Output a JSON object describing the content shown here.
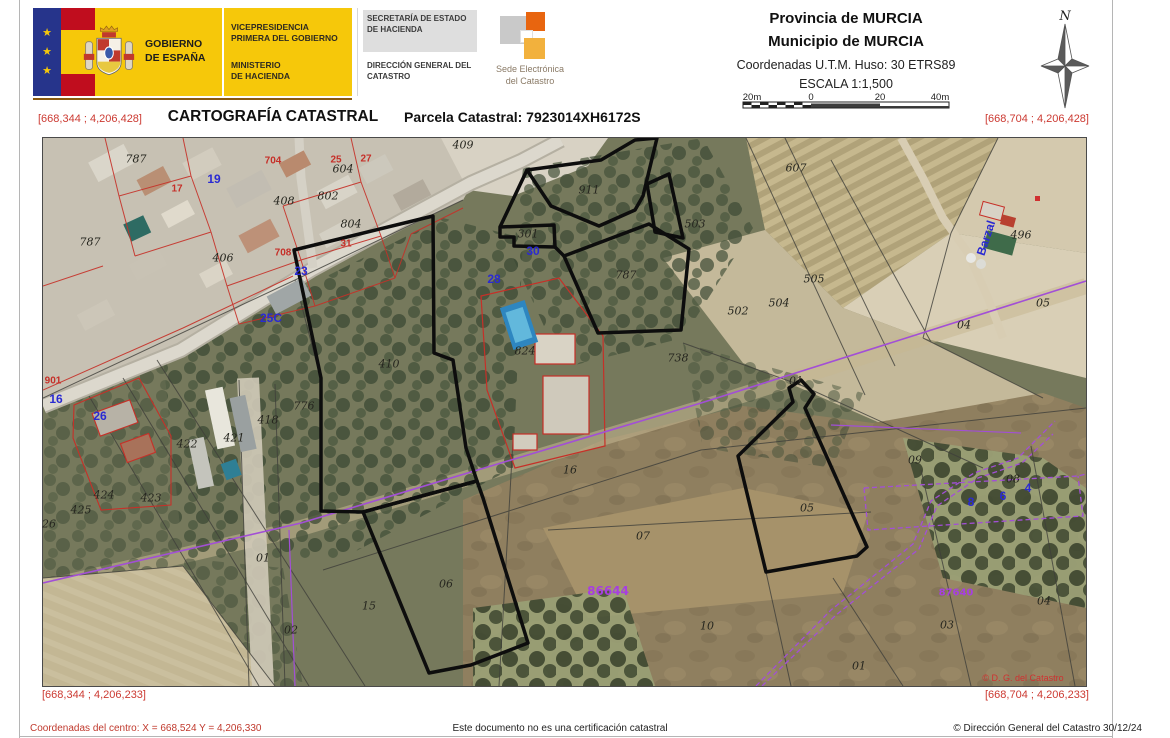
{
  "header": {
    "logo": {
      "gobierno_line1": "GOBIERNO",
      "gobierno_line2": "DE ESPAÑA",
      "vicepresidencia": "VICEPRESIDENCIA PRIMERA DEL GOBIERNO",
      "ministerio_line1": "MINISTERIO",
      "ministerio_line2": "DE HACIENDA"
    },
    "secretaria": "SECRETARÍA DE ESTADO DE HACIENDA",
    "direccion": "DIRECCIÓN GENERAL DEL CATASTRO",
    "sede_line1": "Sede Electrónica",
    "sede_line2": "del Catastro",
    "provincia": "Provincia de MURCIA",
    "municipio": "Municipio de MURCIA",
    "utm": "Coordenadas U.T.M. Huso: 30 ETRS89",
    "escala": "ESCALA 1:1,500",
    "scalebar_labels": [
      "20m",
      "0",
      "20",
      "40m"
    ],
    "north_label": "N"
  },
  "title_row": {
    "title": "CARTOGRAFÍA CATASTRAL",
    "parcel": "Parcela Catastral: 7923014XH6172S"
  },
  "map_corners": {
    "top_left": "[668,344 ; 4,206,428]",
    "top_right": "[668,704 ; 4,206,428]",
    "bottom_left": "[668,344 ; 4,206,233]",
    "bottom_right": "[668,704 ; 4,206,233]"
  },
  "map": {
    "labels": [
      {
        "t": "409",
        "x": 420,
        "y": 7,
        "c": "k"
      },
      {
        "t": "911",
        "x": 546,
        "y": 52,
        "c": "k"
      },
      {
        "t": "503",
        "x": 652,
        "y": 86,
        "c": "k"
      },
      {
        "t": "301",
        "x": 485,
        "y": 96,
        "c": "k"
      },
      {
        "t": "787",
        "x": 583,
        "y": 137,
        "c": "k"
      },
      {
        "t": "607",
        "x": 753,
        "y": 30,
        "c": "k"
      },
      {
        "t": "505",
        "x": 771,
        "y": 141,
        "c": "k"
      },
      {
        "t": "504",
        "x": 736,
        "y": 165,
        "c": "k"
      },
      {
        "t": "502",
        "x": 695,
        "y": 173,
        "c": "k"
      },
      {
        "t": "496",
        "x": 978,
        "y": 97,
        "c": "k"
      },
      {
        "t": "738",
        "x": 635,
        "y": 220,
        "c": "k"
      },
      {
        "t": "410",
        "x": 346,
        "y": 226,
        "c": "k"
      },
      {
        "t": "824",
        "x": 482,
        "y": 213,
        "c": "k"
      },
      {
        "t": "16",
        "x": 527,
        "y": 332,
        "c": "k"
      },
      {
        "t": "422",
        "x": 144,
        "y": 306,
        "c": "k"
      },
      {
        "t": "421",
        "x": 191,
        "y": 300,
        "c": "k"
      },
      {
        "t": "418",
        "x": 225,
        "y": 282,
        "c": "k"
      },
      {
        "t": "424",
        "x": 61,
        "y": 357,
        "c": "k"
      },
      {
        "t": "425",
        "x": 38,
        "y": 372,
        "c": "k"
      },
      {
        "t": "423",
        "x": 108,
        "y": 360,
        "c": "k"
      },
      {
        "t": "26",
        "x": 6,
        "y": 386,
        "c": "k"
      },
      {
        "t": "776",
        "x": 261,
        "y": 268,
        "c": "k"
      },
      {
        "t": "787",
        "x": 47,
        "y": 104,
        "c": "k"
      },
      {
        "t": "787",
        "x": 93,
        "y": 21,
        "c": "k"
      },
      {
        "t": "406",
        "x": 180,
        "y": 120,
        "c": "k"
      },
      {
        "t": "408",
        "x": 241,
        "y": 63,
        "c": "k"
      },
      {
        "t": "604",
        "x": 300,
        "y": 31,
        "c": "k"
      },
      {
        "t": "802",
        "x": 285,
        "y": 58,
        "c": "k"
      },
      {
        "t": "804",
        "x": 308,
        "y": 86,
        "c": "k"
      },
      {
        "t": "07",
        "x": 600,
        "y": 398,
        "c": "k"
      },
      {
        "t": "10",
        "x": 664,
        "y": 488,
        "c": "k"
      },
      {
        "t": "06",
        "x": 403,
        "y": 446,
        "c": "k"
      },
      {
        "t": "15",
        "x": 326,
        "y": 468,
        "c": "k"
      },
      {
        "t": "02",
        "x": 248,
        "y": 492,
        "c": "k"
      },
      {
        "t": "01",
        "x": 220,
        "y": 420,
        "c": "k"
      },
      {
        "t": "01",
        "x": 816,
        "y": 528,
        "c": "k"
      },
      {
        "t": "01",
        "x": 753,
        "y": 243,
        "c": "k"
      },
      {
        "t": "03",
        "x": 904,
        "y": 487,
        "c": "k"
      },
      {
        "t": "04",
        "x": 1001,
        "y": 463,
        "c": "k"
      },
      {
        "t": "04",
        "x": 921,
        "y": 187,
        "c": "k"
      },
      {
        "t": "05",
        "x": 1000,
        "y": 165,
        "c": "k"
      },
      {
        "t": "05",
        "x": 764,
        "y": 370,
        "c": "k"
      },
      {
        "t": "08",
        "x": 970,
        "y": 341,
        "c": "k"
      },
      {
        "t": "09",
        "x": 872,
        "y": 322,
        "c": "k"
      },
      {
        "t": "17",
        "x": 134,
        "y": 51,
        "c": "r"
      },
      {
        "t": "704",
        "x": 230,
        "y": 23,
        "c": "r"
      },
      {
        "t": "708",
        "x": 240,
        "y": 115,
        "c": "r"
      },
      {
        "t": "25",
        "x": 293,
        "y": 22,
        "c": "r"
      },
      {
        "t": "27",
        "x": 323,
        "y": 21,
        "c": "r"
      },
      {
        "t": "31",
        "x": 303,
        "y": 106,
        "c": "r"
      },
      {
        "t": "901",
        "x": 10,
        "y": 243,
        "c": "r"
      },
      {
        "t": "19",
        "x": 171,
        "y": 41,
        "c": "b"
      },
      {
        "t": "23",
        "x": 258,
        "y": 133,
        "c": "b"
      },
      {
        "t": "25C",
        "x": 228,
        "y": 180,
        "c": "b"
      },
      {
        "t": "26",
        "x": 57,
        "y": 278,
        "c": "b"
      },
      {
        "t": "16",
        "x": 13,
        "y": 261,
        "c": "b"
      },
      {
        "t": "28",
        "x": 451,
        "y": 141,
        "c": "b"
      },
      {
        "t": "30",
        "x": 490,
        "y": 113,
        "c": "b"
      },
      {
        "t": "8",
        "x": 928,
        "y": 364,
        "c": "b"
      },
      {
        "t": "6",
        "x": 960,
        "y": 358,
        "c": "b"
      },
      {
        "t": "4",
        "x": 985,
        "y": 350,
        "c": "b"
      },
      {
        "t": "Barzal",
        "x": 943,
        "y": 100,
        "c": "b",
        "r": -72
      },
      {
        "t": "86644",
        "x": 565,
        "y": 453,
        "c": "p",
        "fs": 12
      },
      {
        "t": "87640",
        "x": 913,
        "y": 455,
        "c": "p",
        "fs": 10
      },
      {
        "t": "© D. G. del Catastro",
        "x": 980,
        "y": 540,
        "c": "cr"
      }
    ]
  },
  "footer": {
    "left": "Coordenadas del centro: X = 668,524 Y = 4,206,330",
    "center": "Este documento no es una certificación catastral",
    "right": "© Dirección General del Catastro 30/12/24"
  },
  "colors": {
    "accent_yellow": "#f6c80a",
    "corner_red": "#cc3a32",
    "label_black": "#26261f",
    "label_red": "#c62f28",
    "label_blue": "#2a2ad2",
    "label_purple": "#a73fe0"
  }
}
